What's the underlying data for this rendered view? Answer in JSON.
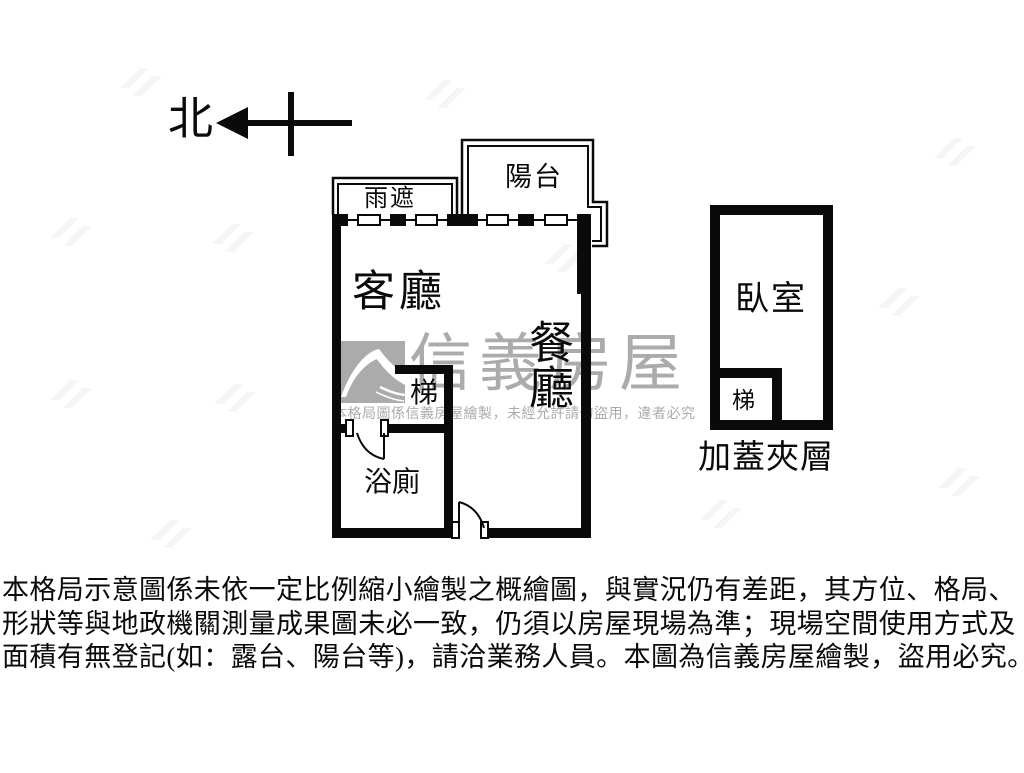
{
  "colors": {
    "ink": "#0a0a0a",
    "watermark": "#ababab",
    "background": "#ffffff"
  },
  "compass": {
    "label": "北"
  },
  "plan": {
    "main_unit": {
      "living_room": "客廳",
      "dining_room": "餐廳",
      "stairs": "梯",
      "bathroom": "浴廁",
      "canopy": "雨遮",
      "balcony": "陽台"
    },
    "annex_unit": {
      "bedroom": "臥室",
      "stairs": "梯",
      "caption": "加蓋夾層"
    }
  },
  "watermark": {
    "logo": "sinyi-roof-logo",
    "brand": "信義房屋",
    "notice": "本格局圖係信義房屋繪製，未經允許請勿盜用，違者必究"
  },
  "disclaimer": {
    "line1": "本格局示意圖係未依一定比例縮小繪製之概繪圖，與實況仍有差距，其方位、格局、",
    "line2": "形狀等與地政機關測量成果圖未必一致，仍須以房屋現場為準；現場空間使用方式及",
    "line3": "面積有無登記(如：露台、陽台等)，請洽業務人員。本圖為信義房屋繪製，盜用必究。"
  }
}
